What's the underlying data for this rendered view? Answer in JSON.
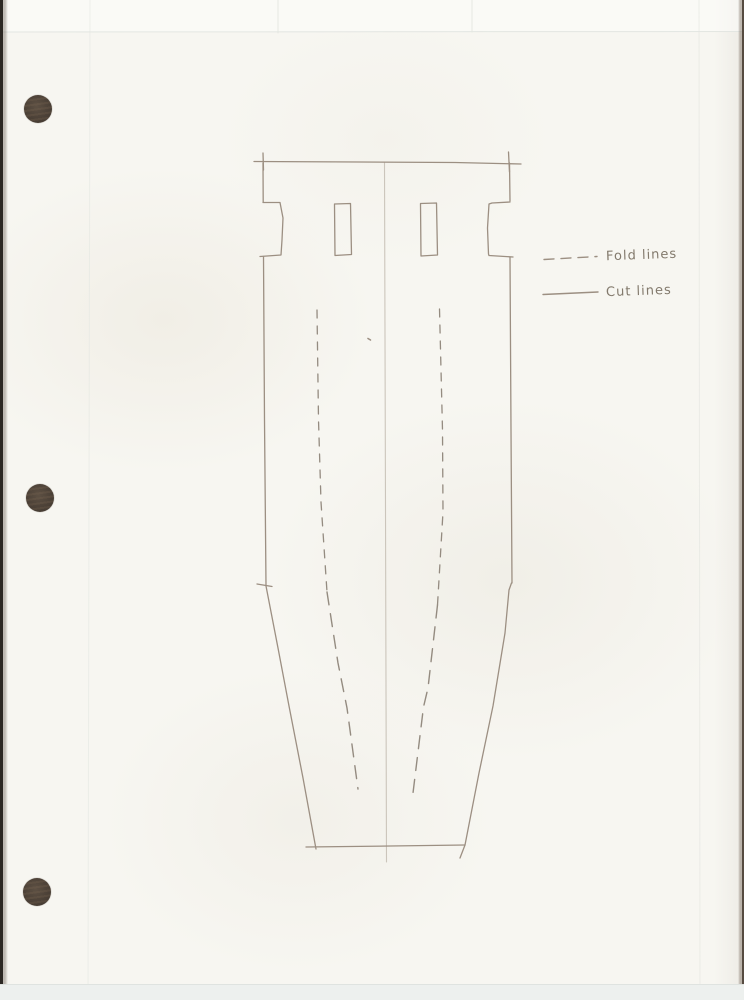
{
  "document": {
    "kind": "scanned hand-drawn pattern template on hole-punched paper"
  },
  "legend": {
    "items": [
      {
        "style": "dashed",
        "label": "Fold lines"
      },
      {
        "style": "solid",
        "label": "Cut lines"
      }
    ]
  },
  "colors": {
    "paper": "#f7f6f1",
    "pencil": "#9c8f82",
    "pencil_dark": "#948b80",
    "pencil_soft": "#c7c0b5",
    "faint": "#e2e5e0",
    "legend_text": "#837a6d",
    "hole": "#4c4137",
    "bottom_band": "#edf0ee",
    "edge_left": "#2c2823",
    "edge_right": "#564b41"
  },
  "holes": [
    {
      "cx": 38,
      "cy": 109,
      "r": 14
    },
    {
      "cx": 40,
      "cy": 498,
      "r": 14
    },
    {
      "cx": 37,
      "cy": 892,
      "r": 14
    }
  ],
  "drawing": {
    "strokes": [
      {
        "name": "faint-grid-h-top",
        "color": "faint",
        "width": 1,
        "opacity": 0.95,
        "points": [
          [
            0,
            32
          ],
          [
            744,
            31.5
          ]
        ]
      },
      {
        "name": "faint-grid-v-1",
        "color": "faint",
        "width": 1,
        "opacity": 0.55,
        "points": [
          [
            90,
            0
          ],
          [
            88,
            1000
          ]
        ]
      },
      {
        "name": "faint-grid-v-2",
        "color": "faint",
        "width": 1,
        "opacity": 0.9,
        "points": [
          [
            278,
            0
          ],
          [
            278,
            33
          ]
        ]
      },
      {
        "name": "faint-grid-v-3",
        "color": "faint",
        "width": 1,
        "opacity": 0.9,
        "points": [
          [
            472,
            0
          ],
          [
            472,
            32
          ]
        ]
      },
      {
        "name": "faint-grid-v-4",
        "color": "faint",
        "width": 1,
        "opacity": 0.6,
        "points": [
          [
            699,
            0
          ],
          [
            700,
            1000
          ]
        ]
      },
      {
        "name": "center-guide-line",
        "color": "pencil_soft",
        "width": 1.1,
        "opacity": 0.9,
        "points": [
          [
            384.5,
            163
          ],
          [
            385.5,
            510
          ],
          [
            386.5,
            862
          ]
        ]
      },
      {
        "name": "top-edge-line",
        "color": "pencil",
        "width": 1.3,
        "points": [
          [
            254,
            161.5
          ],
          [
            360,
            162
          ],
          [
            455,
            162.5
          ],
          [
            521,
            164
          ]
        ]
      },
      {
        "name": "top-left-corner-tick",
        "color": "pencil",
        "width": 1.3,
        "points": [
          [
            263,
            153
          ],
          [
            263.5,
            170
          ]
        ]
      },
      {
        "name": "top-right-corner-tick",
        "color": "pencil",
        "width": 1.3,
        "points": [
          [
            508.5,
            152
          ],
          [
            509.5,
            172
          ]
        ]
      },
      {
        "name": "left-edge-upper",
        "color": "pencil",
        "width": 1.3,
        "points": [
          [
            263,
            163
          ],
          [
            263.2,
            202
          ]
        ]
      },
      {
        "name": "left-edge-notch",
        "color": "pencil",
        "width": 1.3,
        "points": [
          [
            263,
            202.5
          ],
          [
            280,
            202.5
          ],
          [
            283,
            218
          ],
          [
            282,
            240
          ],
          [
            281,
            255
          ],
          [
            260,
            256.5
          ]
        ]
      },
      {
        "name": "left-edge-mid",
        "color": "pencil",
        "width": 1.3,
        "points": [
          [
            263.5,
            256.5
          ],
          [
            264.5,
            420
          ],
          [
            266,
            585
          ]
        ]
      },
      {
        "name": "left-bend-tick",
        "color": "pencil",
        "width": 1.3,
        "points": [
          [
            257,
            584
          ],
          [
            272,
            586.5
          ]
        ]
      },
      {
        "name": "left-slant-edge",
        "color": "pencil",
        "width": 1.3,
        "points": [
          [
            266,
            586
          ],
          [
            278,
            648
          ],
          [
            289,
            706
          ],
          [
            303,
            778
          ],
          [
            316,
            849
          ]
        ]
      },
      {
        "name": "bottom-edge-line",
        "color": "pencil",
        "width": 1.3,
        "points": [
          [
            306,
            847
          ],
          [
            390,
            846
          ],
          [
            465,
            845
          ]
        ]
      },
      {
        "name": "right-slant-edge",
        "color": "pencil",
        "width": 1.3,
        "points": [
          [
            511.5,
            583
          ],
          [
            509,
            590
          ],
          [
            505,
            633
          ],
          [
            493,
            706
          ],
          [
            479,
            773
          ],
          [
            465,
            845
          ],
          [
            460,
            858
          ]
        ]
      },
      {
        "name": "right-edge-upper",
        "color": "pencil",
        "width": 1.3,
        "points": [
          [
            509.5,
            163
          ],
          [
            510,
            201
          ]
        ]
      },
      {
        "name": "right-edge-notch",
        "color": "pencil",
        "width": 1.3,
        "points": [
          [
            510,
            202
          ],
          [
            492,
            203
          ],
          [
            489,
            204
          ],
          [
            487.5,
            228
          ],
          [
            488.5,
            254
          ],
          [
            489,
            255.5
          ],
          [
            513,
            257
          ]
        ]
      },
      {
        "name": "right-edge-mid",
        "color": "pencil",
        "width": 1.3,
        "points": [
          [
            510,
            257
          ],
          [
            511,
            430
          ],
          [
            512,
            583
          ]
        ]
      },
      {
        "name": "slot-left",
        "color": "pencil",
        "width": 1.3,
        "points": [
          [
            334.5,
            204
          ],
          [
            350.5,
            203.5
          ],
          [
            351.5,
            254.5
          ],
          [
            335,
            255.5
          ],
          [
            334.5,
            204.5
          ]
        ]
      },
      {
        "name": "slot-right",
        "color": "pencil",
        "width": 1.3,
        "points": [
          [
            420.5,
            203.5
          ],
          [
            436.5,
            203
          ],
          [
            437.5,
            255
          ],
          [
            421,
            256
          ],
          [
            420.5,
            204
          ]
        ]
      },
      {
        "name": "fold-line-left-upper",
        "color": "pencil_dark",
        "width": 1.3,
        "dash": "8 8",
        "points": [
          [
            317,
            310
          ],
          [
            318.5,
            420
          ],
          [
            321,
            502
          ],
          [
            327,
            592
          ]
        ]
      },
      {
        "name": "fold-line-left-lower",
        "color": "pencil_dark",
        "width": 1.4,
        "dash": "13 9",
        "points": [
          [
            327,
            592
          ],
          [
            338,
            663
          ],
          [
            347,
            708
          ],
          [
            358,
            789
          ]
        ]
      },
      {
        "name": "fold-line-right-upper",
        "color": "pencil_dark",
        "width": 1.3,
        "dash": "8 8",
        "points": [
          [
            439.5,
            309
          ],
          [
            442.5,
            430
          ],
          [
            443,
            512
          ],
          [
            437.5,
            605
          ]
        ]
      },
      {
        "name": "fold-line-right-lower",
        "color": "pencil_dark",
        "width": 1.4,
        "dash": "13 9",
        "points": [
          [
            437.5,
            605
          ],
          [
            428,
            688
          ],
          [
            423.5,
            707
          ],
          [
            413,
            793
          ]
        ]
      },
      {
        "name": "legend-dashed-sample",
        "color": "pencil",
        "width": 1.4,
        "dash": "10 7",
        "points": [
          [
            544,
            259.5
          ],
          [
            597,
            256.5
          ]
        ]
      },
      {
        "name": "legend-solid-sample",
        "color": "pencil",
        "width": 1.4,
        "points": [
          [
            543,
            294.5
          ],
          [
            598,
            292
          ]
        ]
      },
      {
        "name": "pencil-speck",
        "color": "pencil",
        "width": 1.6,
        "points": [
          [
            368,
            338.5
          ],
          [
            370.5,
            340
          ]
        ]
      }
    ]
  }
}
